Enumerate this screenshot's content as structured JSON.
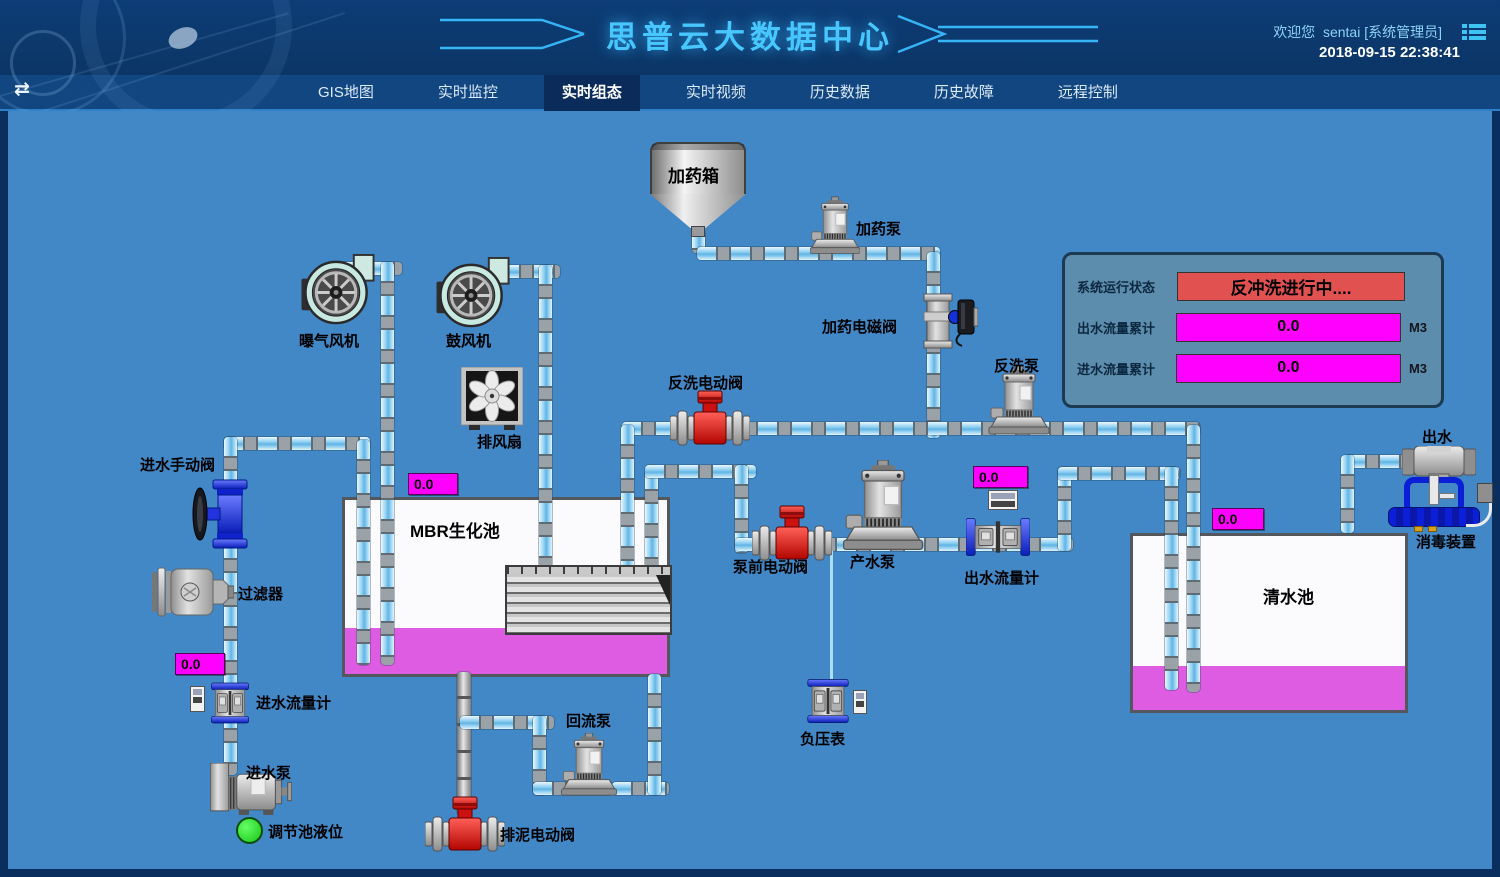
{
  "header": {
    "title": "思普云大数据中心",
    "welcome": "欢迎您",
    "user": "sentai [系统管理员]",
    "datetime": "2018-09-15 22:38:41"
  },
  "nav": {
    "active_index": 2,
    "items": [
      {
        "label": "GIS地图"
      },
      {
        "label": "实时监控"
      },
      {
        "label": "实时组态"
      },
      {
        "label": "实时视频"
      },
      {
        "label": "历史数据"
      },
      {
        "label": "历史故障"
      },
      {
        "label": "远程控制"
      }
    ]
  },
  "panel": {
    "status_label": "系统运行状态",
    "status_value": "反冲洗进行中....",
    "rows": [
      {
        "label": "出水流量累计",
        "value": "0.0",
        "unit": "M3"
      },
      {
        "label": "进水流量累计",
        "value": "0.0",
        "unit": "M3"
      }
    ]
  },
  "diagram": {
    "labels": {
      "dosing_tank": "加药箱",
      "dosing_pump": "加药泵",
      "dosing_valve": "加药电磁阀",
      "aeration_blower": "曝气风机",
      "blower": "鼓风机",
      "exhaust_fan": "排风扇",
      "backwash_valve": "反洗电动阀",
      "backwash_pump": "反洗泵",
      "inlet_manual_valve": "进水手动阀",
      "filter": "过滤器",
      "inlet_flowmeter": "进水流量计",
      "inlet_pump": "进水泵",
      "tank_level": "调节池液位",
      "mbr_tank": "MBR生化池",
      "return_pump": "回流泵",
      "sludge_valve": "排泥电动阀",
      "prepump_valve": "泵前电动阀",
      "product_pump": "产水泵",
      "outlet_flowmeter": "出水流量计",
      "vacuum_gauge": "负压表",
      "clean_tank": "清水池",
      "outlet": "出水",
      "disinfection": "消毒装置"
    },
    "values": {
      "mbr_level": "0.0",
      "inlet_flow": "0.0",
      "outlet_flow": "0.0",
      "clean_level": "0.0"
    }
  },
  "colors": {
    "canvas_bg": "#4287c6",
    "header_bg": "#0d3d76",
    "active_tab_bg": "#0b2c5a",
    "title_accent": "#48c7fe",
    "magenta": "#ff00ff",
    "tank_liquid": "#dd5ce2",
    "status_red": "#e0514f",
    "pipe_blue": "#8ccdf0",
    "alarm_green": "#17c517"
  }
}
